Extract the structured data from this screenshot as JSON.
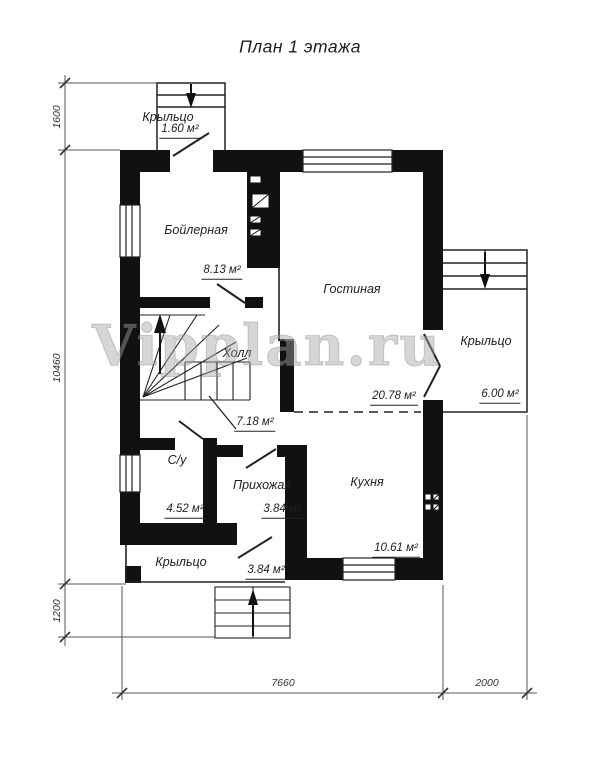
{
  "title": "План 1 этажа",
  "watermark": "Vipplan.ru",
  "rooms": {
    "boiler": {
      "name": "Бойлерная",
      "area": "8.13 м²"
    },
    "living": {
      "name": "Гостиная",
      "area": "20.78 м²"
    },
    "hall": {
      "name": "Холл",
      "area": "7.18 м²"
    },
    "wc": {
      "name": "С/у",
      "area": "4.52 м²"
    },
    "entry": {
      "name": "Прихожая",
      "area": "3.84 м²"
    },
    "kitchen": {
      "name": "Кухня",
      "area": "10.61 м²"
    },
    "porch_top": {
      "name": "Крыльцо",
      "area": "1.60 м²"
    },
    "porch_right": {
      "name": "Крыльцо",
      "area": "6.00 м²"
    },
    "porch_bottom": {
      "name": "Крыльцо",
      "area": "3.84 м²"
    }
  },
  "dimensions": {
    "left": [
      {
        "label": "1600"
      },
      {
        "label": "10460"
      },
      {
        "label": "1200"
      }
    ],
    "bottom": [
      {
        "label": "7660"
      },
      {
        "label": "2000"
      }
    ]
  },
  "colors": {
    "wall": "#111111",
    "line": "#222222",
    "dim": "#555555",
    "watermark": "#a5a5a5"
  }
}
